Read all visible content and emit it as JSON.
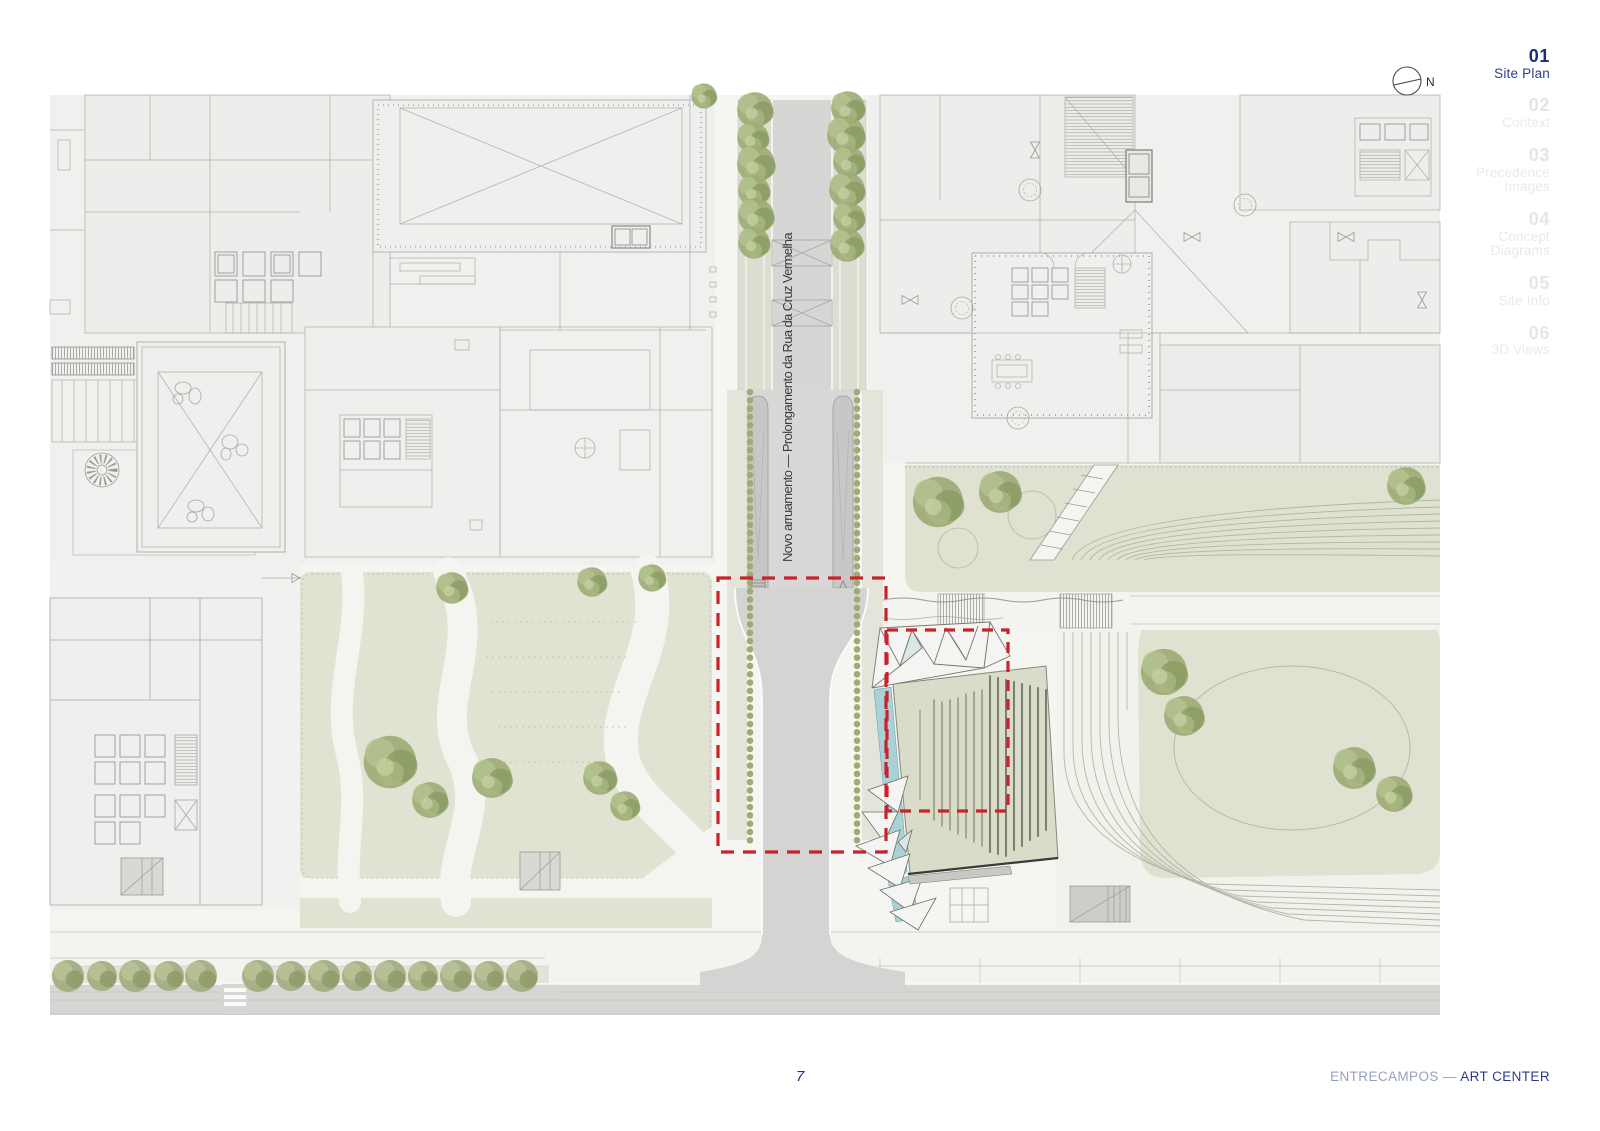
{
  "slide": {
    "compass_label": "N",
    "page_number": "7",
    "footer": {
      "project_prefix": "ENTRECAMPOS — ",
      "project_title": "ART CENTER"
    }
  },
  "nav": {
    "items": [
      {
        "number": "01",
        "lines": [
          "Site Plan"
        ],
        "active": true
      },
      {
        "number": "02",
        "lines": [
          "Context"
        ],
        "active": false
      },
      {
        "number": "03",
        "lines": [
          "Precedence",
          "Images"
        ],
        "active": false
      },
      {
        "number": "04",
        "lines": [
          "Concept",
          "Diagrams"
        ],
        "active": false
      },
      {
        "number": "05",
        "lines": [
          "Site Info"
        ],
        "active": false
      },
      {
        "number": "06",
        "lines": [
          "3D Views"
        ],
        "active": false
      }
    ]
  },
  "plan": {
    "road_label": "Novo arruamento — Prolongamento da Rua da Cruz Vermelha",
    "colors": {
      "highlight_red": "#c8232c",
      "lawn_green": "#dfe2d1",
      "tree_green": "#9cab74",
      "road_gray": "#d6d6d4",
      "water_blue": "#a9d2d8",
      "accent_navy": "#1c2b7a"
    }
  }
}
